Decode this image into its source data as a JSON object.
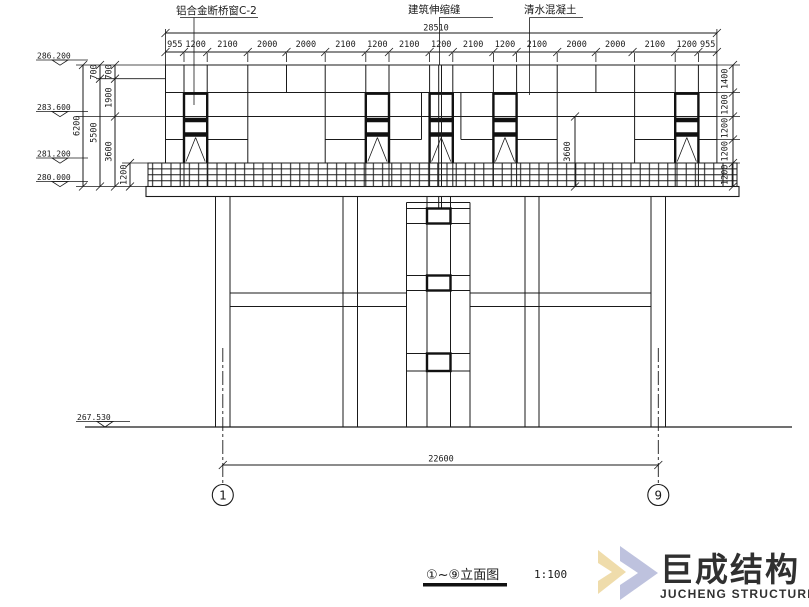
{
  "callouts": {
    "window": "铝合金断桥窗C-2",
    "joint": "建筑伸缩缝",
    "concrete": "清水混凝土"
  },
  "dims": {
    "overall": "28510",
    "top": [
      "955",
      "1200",
      "2100",
      "2000",
      "2000",
      "2100",
      "1200",
      "2100",
      "1200",
      "2100",
      "1200",
      "2100",
      "2000",
      "2000",
      "2100",
      "1200",
      "955"
    ],
    "chain_a": "6200",
    "chain_b": [
      "700",
      "5500"
    ],
    "chain_c": [
      "700",
      "1900",
      "3600"
    ],
    "chain_d": "1200",
    "right": [
      "1400",
      "1200",
      "1200",
      "1200",
      "1200"
    ],
    "inner": "3600",
    "bottom": "22600"
  },
  "elev": {
    "top": "286.200",
    "mid": "283.600",
    "low": "281.200",
    "base": "280.000",
    "ground": "267.530"
  },
  "axes": {
    "left": "1",
    "right": "9"
  },
  "title": {
    "text": "①~⑨立面图",
    "scale": "1:100"
  },
  "watermark": {
    "cn": "巨成结构",
    "en": "JUCHENG STRUCTURE"
  },
  "colors": {
    "line": "#1a1a1a",
    "wm_blue": "#b7bcdb",
    "wm_yellow": "#eed9a3",
    "wm_gray": "#bcbdc4"
  }
}
